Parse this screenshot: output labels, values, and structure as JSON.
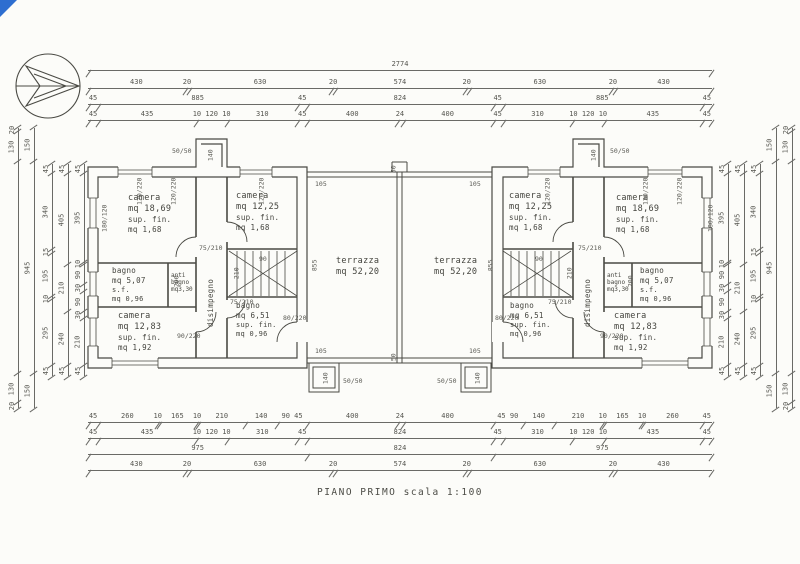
{
  "caption": "PIANO PRIMO scala 1:100",
  "corner_mark_color": "#2e6ed0",
  "rooms": {
    "camera_1869": {
      "name": "camera",
      "area": "mq 18,69",
      "fin_label": "sup. fin.",
      "fin_area": "mq 1,68"
    },
    "camera_1225": {
      "name": "camera",
      "area": "mq 12,25",
      "fin_label": "sup. fin.",
      "fin_area": "mq 1,68"
    },
    "camera_1283": {
      "name": "camera",
      "area": "mq 12,83",
      "fin_label": "sup. fin.",
      "fin_area": "mq 1,92"
    },
    "bagno_507": {
      "name": "bagno",
      "area": "mq 5,07",
      "fin_label": "s.f.",
      "fin_area": "mq 0,96"
    },
    "bagno_651": {
      "name": "bagno",
      "area": "mq 6,51",
      "fin_label": "sup. fin.",
      "fin_area": "mq 0,96"
    },
    "antibagno": {
      "line1": "anti",
      "line2": "bagno",
      "line3": "mq3,30"
    },
    "disimpegno": {
      "name": "disimpegno"
    },
    "terrazza": {
      "name": "terrazza",
      "area": "mq 52,20"
    }
  },
  "small_labels": {
    "t105": "105",
    "t855": "855",
    "t50": "50",
    "t140": "140",
    "t5050": "50/50",
    "door75": "75/210",
    "door80": "80/220",
    "door90": "90/220",
    "win180": "180/120",
    "win120": "120/220",
    "stair90": "90",
    "t210": "210",
    "t200": "200"
  },
  "dim_chains": {
    "t1": [
      [
        2774,
        "2774"
      ]
    ],
    "t2": [
      [
        430,
        "430"
      ],
      [
        20,
        "20"
      ],
      [
        630,
        "630"
      ],
      [
        20,
        "20"
      ],
      [
        574,
        "574"
      ],
      [
        20,
        "20"
      ],
      [
        630,
        "630"
      ],
      [
        20,
        "20"
      ],
      [
        430,
        "430"
      ]
    ],
    "t3": [
      [
        45,
        "45"
      ],
      [
        885,
        "885"
      ],
      [
        45,
        "45"
      ],
      [
        824,
        "824"
      ],
      [
        45,
        "45"
      ],
      [
        885,
        "885"
      ],
      [
        45,
        "45"
      ]
    ],
    "t4": [
      [
        45,
        "45"
      ],
      [
        435,
        "435"
      ],
      [
        140,
        "10 120 10"
      ],
      [
        310,
        "310"
      ],
      [
        45,
        "45"
      ],
      [
        400,
        "400"
      ],
      [
        24,
        "24"
      ],
      [
        400,
        "400"
      ],
      [
        45,
        "45"
      ],
      [
        310,
        "310"
      ],
      [
        140,
        "10 120 10"
      ],
      [
        435,
        "435"
      ],
      [
        45,
        "45"
      ]
    ],
    "b1": [
      [
        45,
        "45"
      ],
      [
        260,
        "260"
      ],
      [
        10,
        "10"
      ],
      [
        165,
        "165"
      ],
      [
        10,
        "10"
      ],
      [
        210,
        "210"
      ],
      [
        140,
        "140"
      ],
      [
        135,
        "90 45"
      ],
      [
        400,
        "400"
      ],
      [
        24,
        "24"
      ],
      [
        400,
        "400"
      ],
      [
        135,
        "45 90"
      ],
      [
        140,
        "140"
      ],
      [
        210,
        "210"
      ],
      [
        10,
        "10"
      ],
      [
        165,
        "165"
      ],
      [
        10,
        "10"
      ],
      [
        260,
        "260"
      ],
      [
        45,
        "45"
      ]
    ],
    "b2": [
      [
        45,
        "45"
      ],
      [
        435,
        "435"
      ],
      [
        140,
        "10 120 10"
      ],
      [
        310,
        "310"
      ],
      [
        45,
        "45"
      ],
      [
        824,
        "824"
      ],
      [
        45,
        "45"
      ],
      [
        310,
        "310"
      ],
      [
        140,
        "10 120 10"
      ],
      [
        435,
        "435"
      ],
      [
        45,
        "45"
      ]
    ],
    "b3": [
      [
        975,
        "975"
      ],
      [
        824,
        "824"
      ],
      [
        975,
        "975"
      ]
    ],
    "b4": [
      [
        430,
        "430"
      ],
      [
        20,
        "20"
      ],
      [
        630,
        "630"
      ],
      [
        20,
        "20"
      ],
      [
        574,
        "574"
      ],
      [
        20,
        "20"
      ],
      [
        630,
        "630"
      ],
      [
        20,
        "20"
      ],
      [
        430,
        "430"
      ]
    ],
    "s0": [
      [
        20,
        "20"
      ],
      [
        130,
        "130"
      ],
      [
        945,
        ""
      ],
      [
        130,
        "130"
      ],
      [
        20,
        "20"
      ]
    ],
    "s1": [
      [
        150,
        "150"
      ],
      [
        945,
        "945"
      ],
      [
        150,
        "150"
      ]
    ],
    "s2": [
      [
        45,
        "45"
      ],
      [
        340,
        "340"
      ],
      [
        15,
        "15"
      ],
      [
        195,
        "195"
      ],
      [
        10,
        "10"
      ],
      [
        295,
        "295"
      ],
      [
        45,
        "45"
      ]
    ],
    "s3": [
      [
        45,
        "45"
      ],
      [
        405,
        "405"
      ],
      [
        210,
        "210"
      ],
      [
        240,
        "240"
      ],
      [
        45,
        "45"
      ]
    ],
    "s4": [
      [
        45,
        "45"
      ],
      [
        395,
        "395"
      ],
      [
        10,
        "10"
      ],
      [
        90,
        "90"
      ],
      [
        30,
        "30"
      ],
      [
        90,
        "90"
      ],
      [
        30,
        "30"
      ],
      [
        210,
        "210"
      ],
      [
        45,
        "45"
      ]
    ]
  }
}
